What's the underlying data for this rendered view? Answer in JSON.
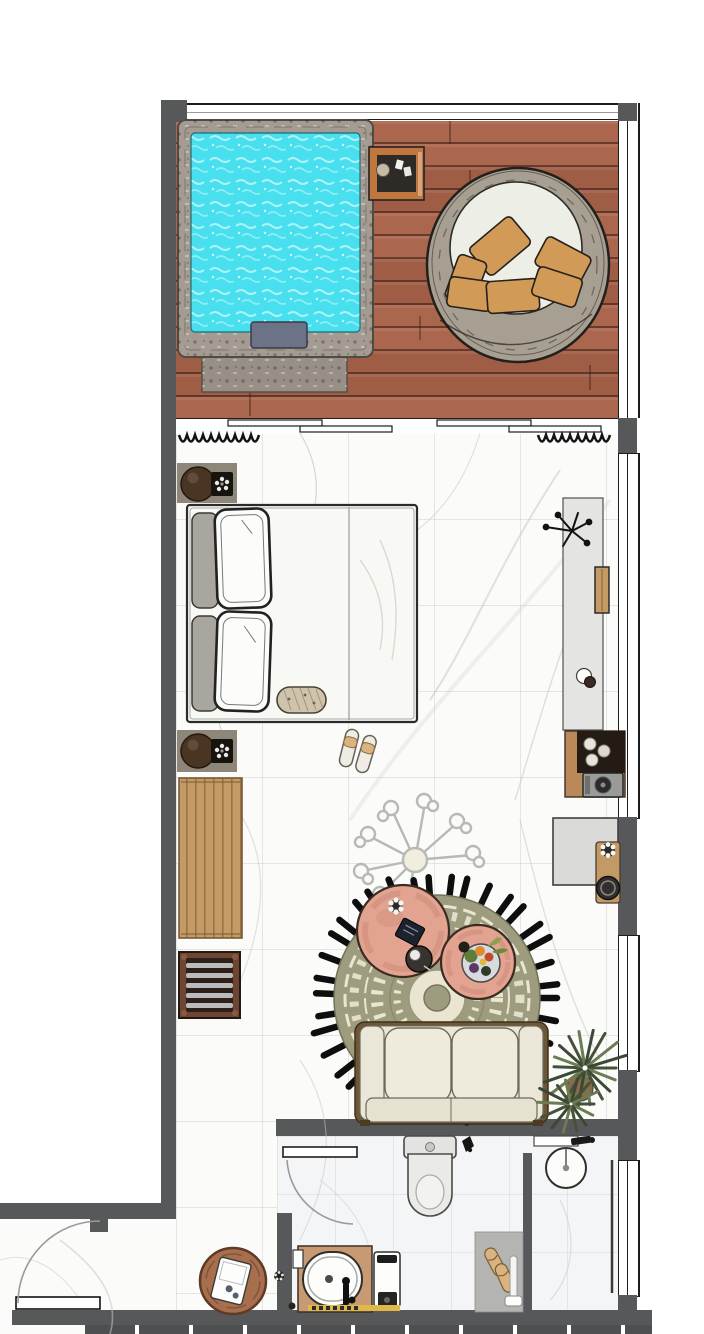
{
  "meta": {
    "title": "hotel-suite-top-view-floor-plan",
    "canvas_width": 704,
    "canvas_height": 1334,
    "text_on_screen": "none"
  },
  "palette": {
    "wall": "#57585a",
    "deck_a": "#ab664e",
    "deck_b": "#9f5d46",
    "pool_stone": "#a49c93",
    "pool_water": "#48dfee",
    "pool_ripple": "#aff2f7",
    "pool_step": "#6d7386",
    "stone_pad": "#988f86",
    "cabinet_orange": "#c0763c",
    "cabinet_dark": "#2e2a26",
    "rattan": "#a79f92",
    "egg_cushion": "#edeee5",
    "pillow_orange": "#d29a57",
    "marble": "#fbfbfa",
    "marble_vein": "#c6c6c4",
    "bath_floor": "#f4f5f7",
    "nightstand": "#8e8678",
    "lamp_brown": "#4a3422",
    "bed_white": "#f8f8f5",
    "pillow_gray": "#a8a69e",
    "console": "#e4e4e2",
    "tv_wood": "#c59a64",
    "minibar_wood": "#b9895a",
    "minibar_dark": "#241b15",
    "machine_gray": "#9a9a98",
    "bench_wood": "#c49b64",
    "rack_frame": "#6e4533",
    "rack_dark": "#2e2019",
    "slat_gray": "#b9bbbd",
    "chand": "#b8b8b6",
    "rug_olive": "#9d9c7f",
    "rug_cream": "#e9e5d1",
    "fringe": "#0e0e0e",
    "table_pink": "#e2a490",
    "sofa_cream": "#ebe7d8",
    "sofa_frame": "#6e5639",
    "plant_dark": "#44523a",
    "plant_light": "#6c7b52",
    "desk_gray": "#dadad8",
    "chair_wood": "#c39a66",
    "seat_dark": "#332f2c",
    "tub_wood": "#c79a73",
    "mat_gray": "#b4b4b2",
    "slipper": "#d9b481",
    "yellow": "#e0b84a",
    "entry_table": "#a76f4e"
  },
  "areas": {
    "pool_deck": {
      "floor": "wood planks",
      "items": [
        "glass-railing",
        "plunge-pool",
        "pool-step",
        "stone-pad",
        "outdoor-cabinet",
        "egg-chair",
        "orange-cushions"
      ]
    },
    "bedroom": {
      "floor": "white marble",
      "items": [
        "sliding-glass-door",
        "curtains",
        "nightstand-top",
        "nightstand-bottom",
        "double-bed",
        "pillows",
        "bolster",
        "slippers",
        "wall-console",
        "decor-branch",
        "tv-panel",
        "coffee-cup",
        "minibar",
        "coffee-machine"
      ]
    },
    "living_area": {
      "floor": "white marble",
      "items": [
        "wood-bench",
        "magazine-rack",
        "ceiling-light",
        "round-fringe-rug",
        "coffee-table-large",
        "coffee-table-small",
        "fruit-bowl",
        "sofa",
        "floor-plant",
        "desk",
        "desk-chair"
      ]
    },
    "bathroom": {
      "floor": "light marble",
      "items": [
        "bathroom-door",
        "toilet",
        "towel-hook",
        "partition-wall",
        "vanity-sink",
        "shower-mat",
        "shower-slippers",
        "shower-glass",
        "bathtub",
        "tub-faucet",
        "tub-cabinet",
        "bath-mat"
      ]
    },
    "entry": {
      "floor": "white marble",
      "items": [
        "entry-door",
        "round-side-table",
        "safe-device"
      ]
    }
  }
}
